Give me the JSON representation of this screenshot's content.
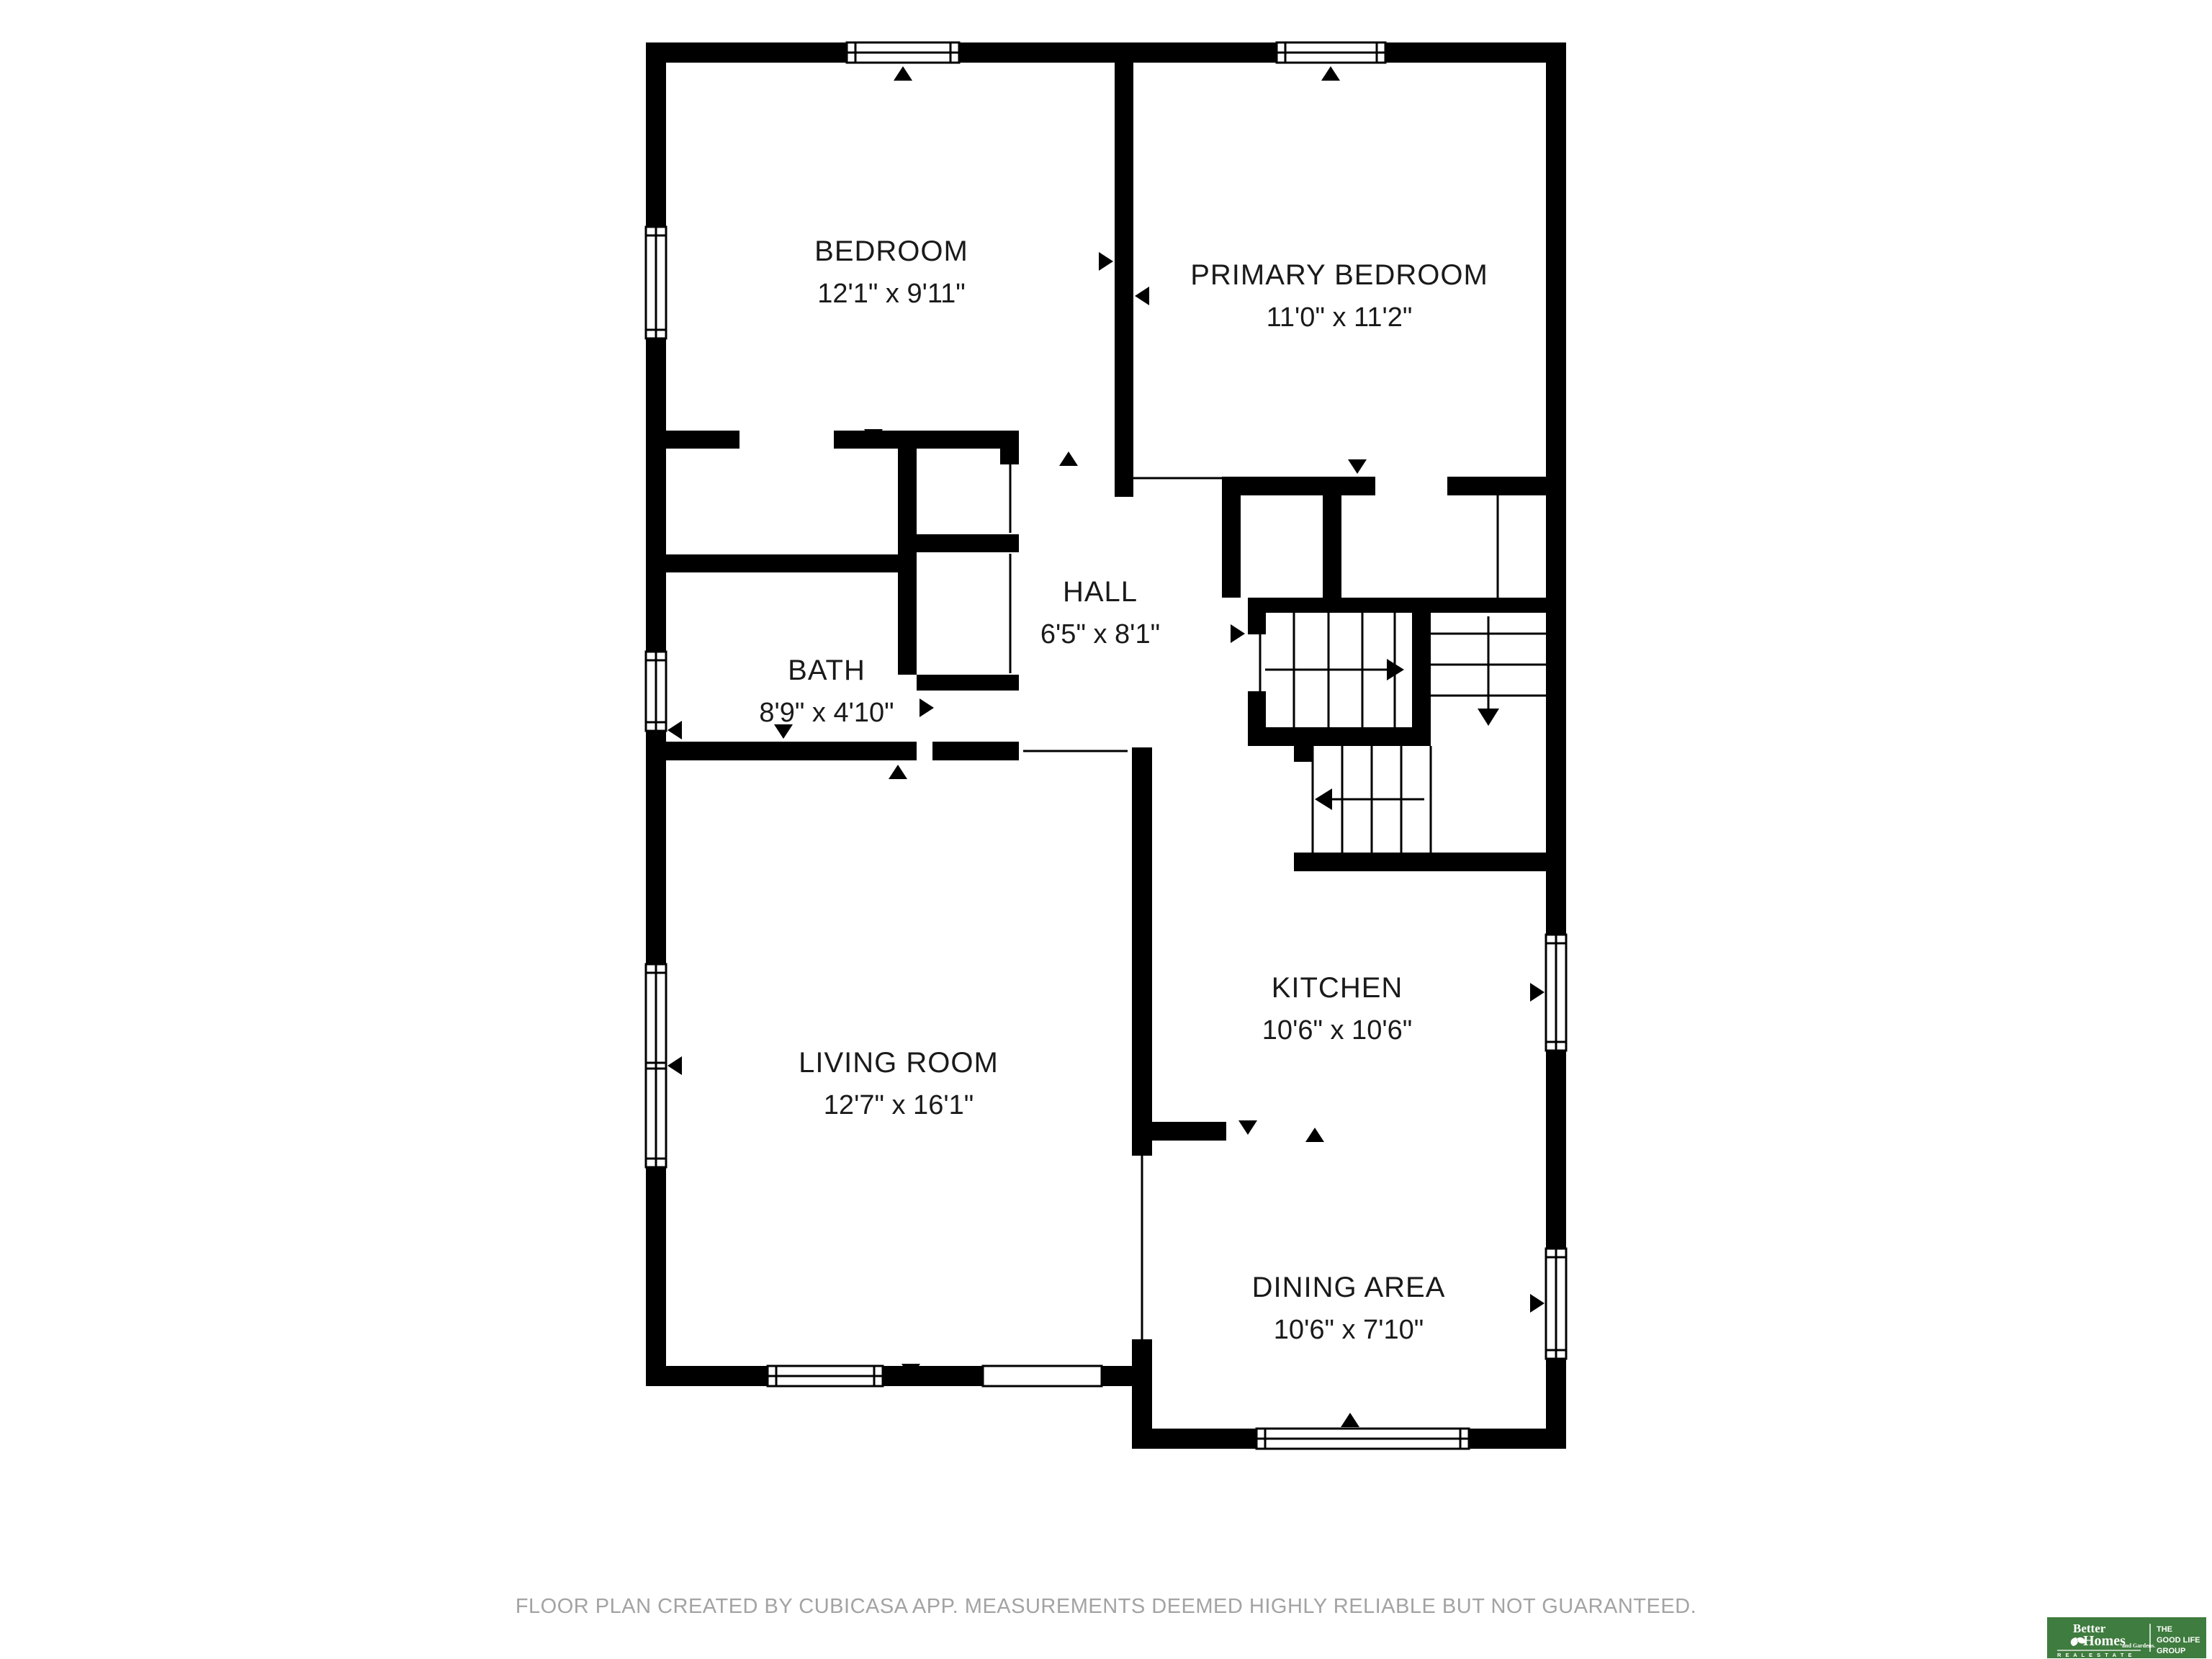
{
  "rooms": {
    "bedroom": {
      "name": "BEDROOM",
      "dims": "12'1\" x 9'11\""
    },
    "primary_bedroom": {
      "name": "PRIMARY BEDROOM",
      "dims": "11'0\" x 11'2\""
    },
    "hall": {
      "name": "HALL",
      "dims": "6'5\" x 8'1\""
    },
    "bath": {
      "name": "BATH",
      "dims": "8'9\" x 4'10\""
    },
    "kitchen": {
      "name": "KITCHEN",
      "dims": "10'6\" x 10'6\""
    },
    "living_room": {
      "name": "LIVING ROOM",
      "dims": "12'7\" x 16'1\""
    },
    "dining_area": {
      "name": "DINING AREA",
      "dims": "10'6\" x 7'10\""
    }
  },
  "footer": {
    "disclaimer": "FLOOR PLAN CREATED BY CUBICASA APP. MEASUREMENTS DEEMED HIGHLY RELIABLE BUT NOT GUARANTEED."
  },
  "logo": {
    "brand_line1": "Better",
    "brand_line2": "Homes",
    "brand_line3": "and Gardens.",
    "brand_tagline": "R E A L   E S T A T E",
    "group_line1": "THE",
    "group_line2": "GOOD LIFE",
    "group_line3": "GROUP",
    "bg_color": "#3f7c3f"
  },
  "colors": {
    "wall": "#000000",
    "label_text": "#1a1a1a",
    "footer_text": "#a3a3a3",
    "logo_green": "#3f7c3f"
  }
}
